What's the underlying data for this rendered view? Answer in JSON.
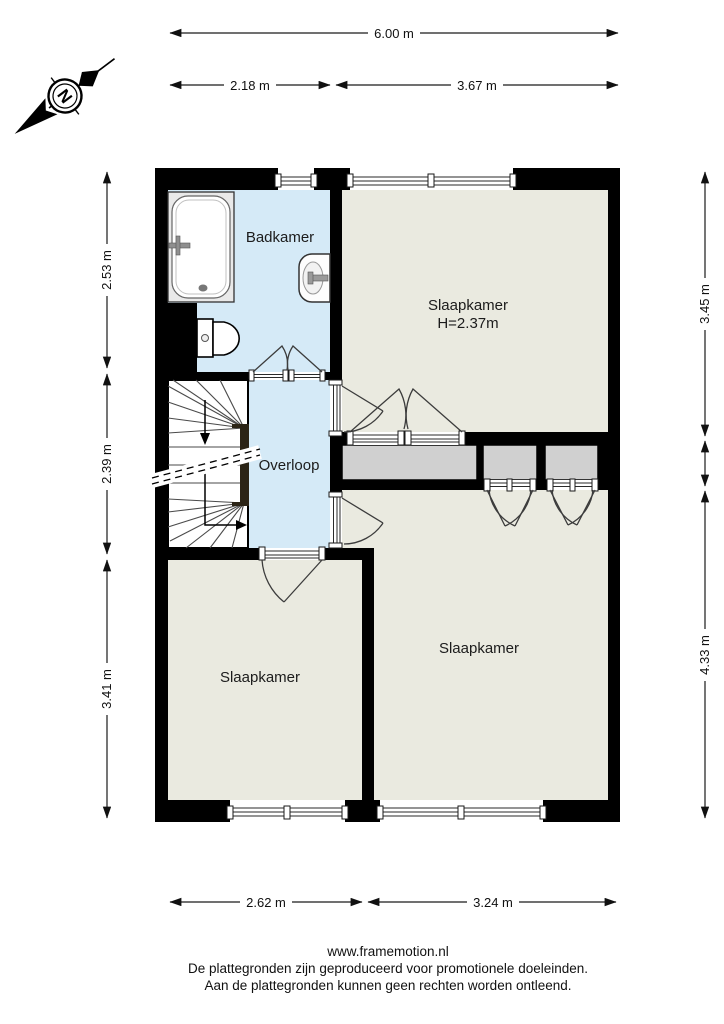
{
  "compass": {
    "label": "N"
  },
  "rooms": {
    "badkamer": "Badkamer",
    "slaapkamer_top": {
      "name": "Slaapkamer",
      "height": "H=2.37m"
    },
    "overloop": "Overloop",
    "slaapkamer_left": "Slaapkamer",
    "slaapkamer_right": "Slaapkamer"
  },
  "dimensions": {
    "top_total": "6.00 m",
    "top_left": "2.18 m",
    "top_right": "3.67 m",
    "left_top": "2.53 m",
    "left_middle": "2.39 m",
    "left_bottom": "3.41 m",
    "right_top": "3.45 m",
    "right_bottom": "4.33 m",
    "bottom_left": "2.62 m",
    "bottom_right": "3.24 m"
  },
  "footer": {
    "website": "www.framemotion.nl",
    "disclaimer_line1": "De plattegronden zijn geproduceerd voor promotionele doeleinden.",
    "disclaimer_line2": "Aan de plattegronden kunnen geen rechten worden ontleend."
  },
  "colors": {
    "wall": "#000000",
    "wet_room": "#d5eaf7",
    "floor": "#eaeae0",
    "closet": "#d0d0d0"
  }
}
